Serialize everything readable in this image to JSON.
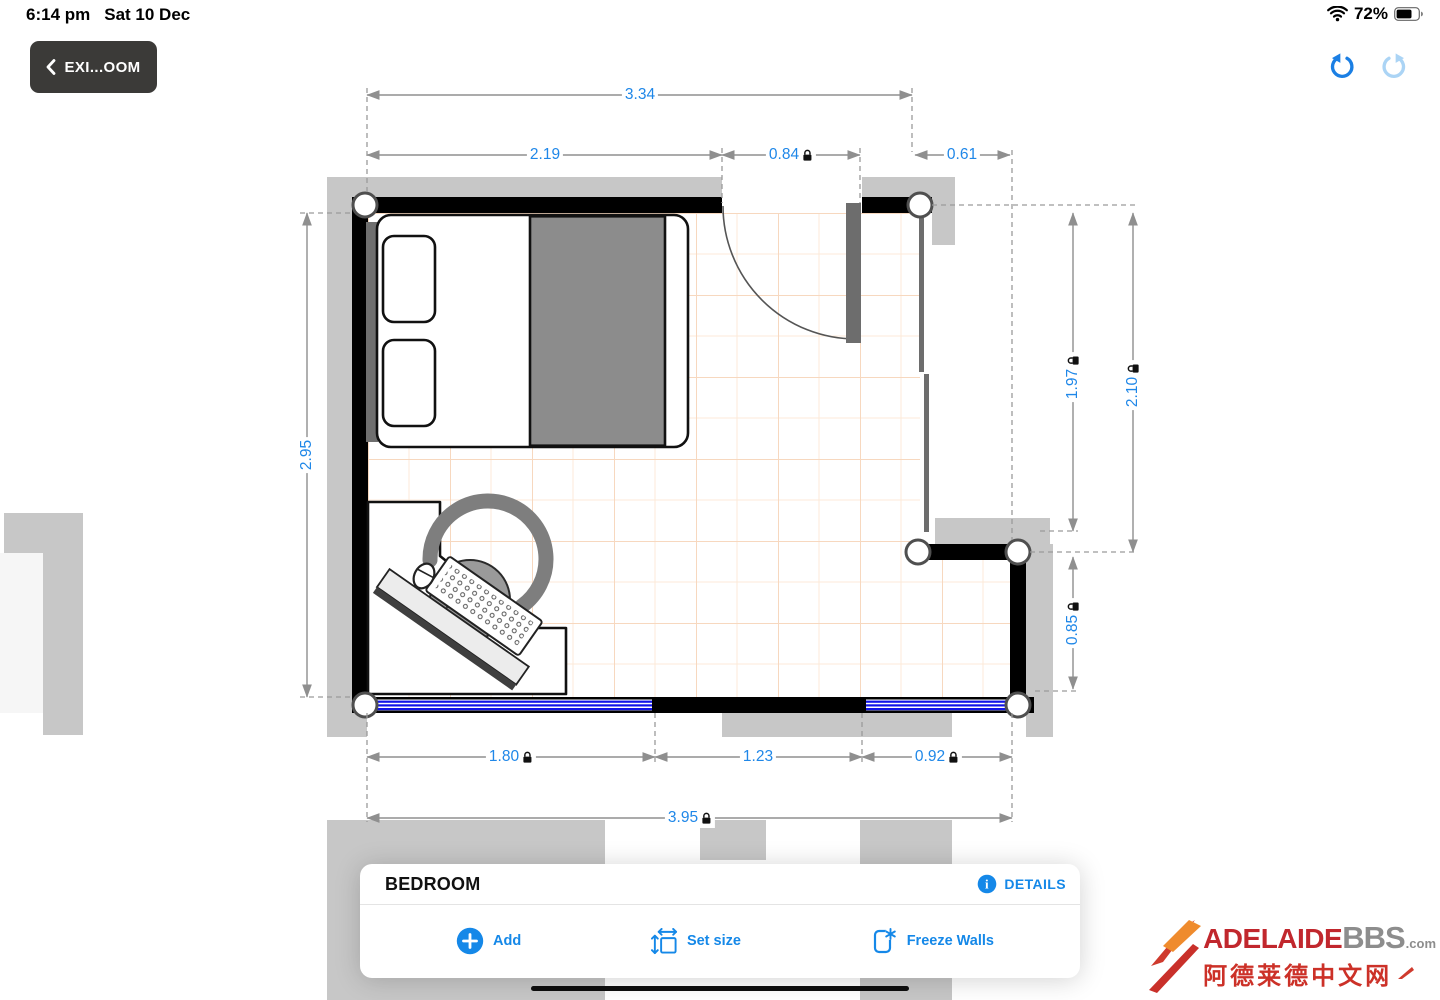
{
  "status_bar": {
    "time": "6:14 pm",
    "date": "Sat 10 Dec",
    "battery_percent": "72%"
  },
  "toolbar": {
    "back_label": "EXI...OOM"
  },
  "dimensions": {
    "top_total": "3.34",
    "top_left": "2.19",
    "top_door": "0.84",
    "top_right": "0.61",
    "left_side": "2.95",
    "right_inner": "1.97",
    "right_outer": "2.10",
    "right_lower": "0.85",
    "bottom_left": "1.80",
    "bottom_middle": "1.23",
    "bottom_right": "0.92",
    "bottom_total": "3.95"
  },
  "panel": {
    "title": "BEDROOM",
    "details_label": "DETAILS",
    "add_label": "Add",
    "set_size_label": "Set size",
    "freeze_walls_label": "Freeze Walls"
  },
  "watermark": {
    "brand_primary": "ADELAIDE",
    "brand_secondary": "BBS",
    "brand_suffix": ".com",
    "tagline": "阿德莱德中文网"
  },
  "icons": {
    "back": "chevron-left-icon",
    "undo": "undo-arrow-icon",
    "redo": "redo-arrow-icon",
    "wifi": "wifi-icon",
    "battery": "battery-icon",
    "details": "info-icon",
    "add": "plus-circle-icon",
    "set_size": "resize-icon",
    "freeze_walls": "freeze-wall-icon",
    "locked_dimension": "lock-icon"
  },
  "colors": {
    "accent_blue": "#1588e8",
    "dimension_blue": "#1f87e8",
    "wall_black": "#000000",
    "exterior_gray": "#c7c7c7",
    "window_blue": "#1013e8",
    "grid_peach": "#f7d8bf",
    "undo_active": "#1b7fe4",
    "redo_disabled": "#abd4f5",
    "watermark_red": "#c1272d",
    "watermark_gray": "#8d8d8d"
  }
}
